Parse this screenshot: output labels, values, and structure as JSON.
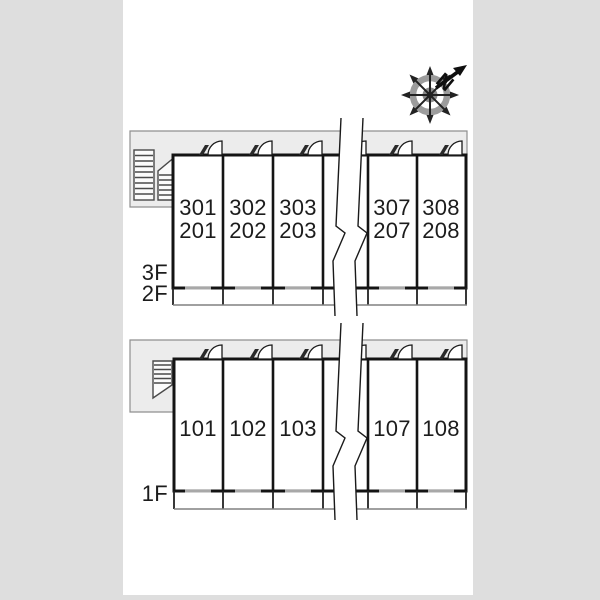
{
  "title": "apartment-floor-plan",
  "compass": {
    "label": "N"
  },
  "floors": {
    "upper": {
      "floor_labels": [
        "3F",
        "2F"
      ],
      "rooms": [
        {
          "line1": "301",
          "line2": "201"
        },
        {
          "line1": "302",
          "line2": "202"
        },
        {
          "line1": "303",
          "line2": "203"
        },
        {
          "line1": "307",
          "line2": "207"
        },
        {
          "line1": "308",
          "line2": "208"
        }
      ]
    },
    "lower": {
      "floor_labels": [
        "1F"
      ],
      "rooms": [
        {
          "line1": "101"
        },
        {
          "line1": "102"
        },
        {
          "line1": "103"
        },
        {
          "line1": "107"
        },
        {
          "line1": "108"
        }
      ]
    }
  },
  "colors": {
    "page_bg": "#dedede",
    "panel_bg": "#ffffff",
    "wall": "#141414",
    "corridor_fill": "#ececec",
    "corridor_border": "#8f8f8f",
    "window_dash": "#a8a8a8",
    "balcony_edge": "#808080",
    "stairs_stroke": "#4a4a4a",
    "text": "#1c1c1c"
  }
}
